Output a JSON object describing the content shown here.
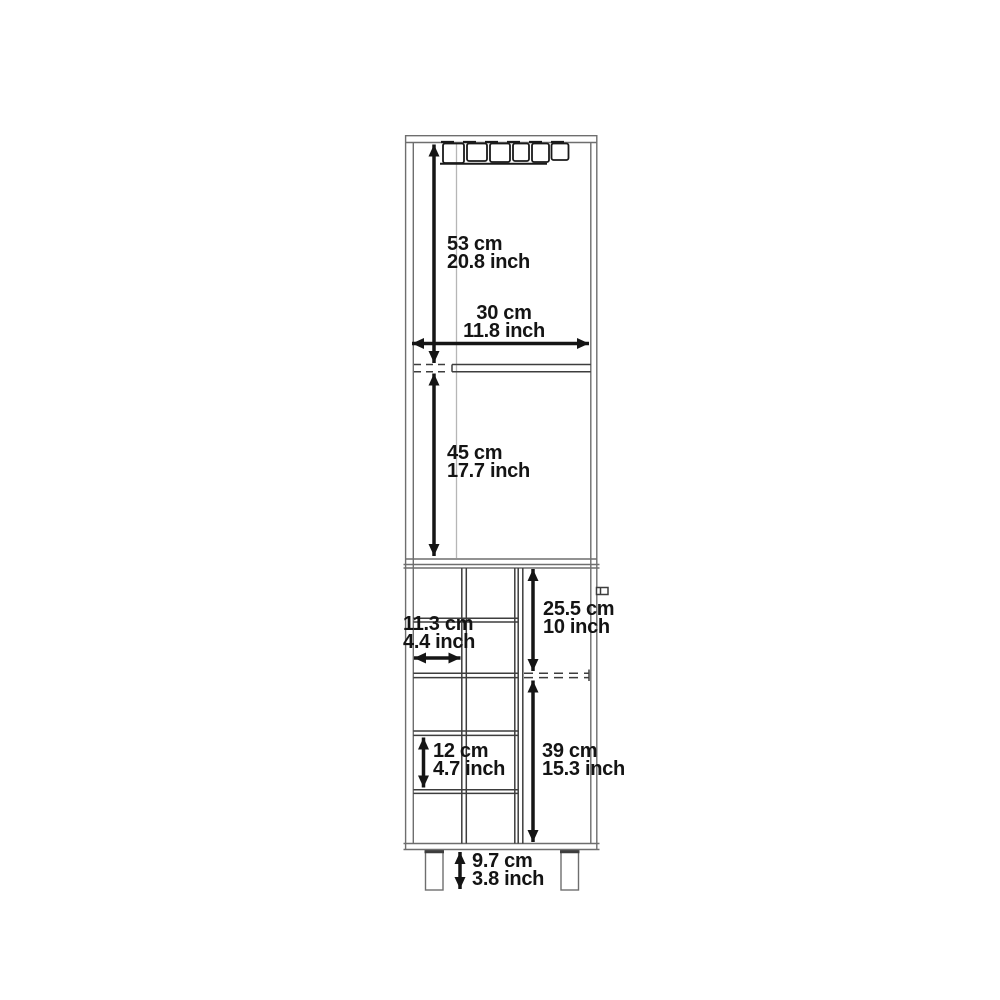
{
  "page": {
    "background": "#ffffff"
  },
  "colors": {
    "outline": "#6e6e6e",
    "detail": "#3d3d3d",
    "faint": "#b6b6b6",
    "ink": "#151515",
    "text": "#141414"
  },
  "dimensions": {
    "upper_section_height": {
      "cm": "53 cm",
      "inch": "20.8 inch"
    },
    "cabinet_width": {
      "cm": "30 cm",
      "inch": "11.8 inch"
    },
    "middle_section_height": {
      "cm": "45 cm",
      "inch": "17.7 inch"
    },
    "cubby_width": {
      "cm": "11.3 cm",
      "inch": "4.4 inch"
    },
    "door_upper_height": {
      "cm": "25.5 cm",
      "inch": "10 inch"
    },
    "cubby_height": {
      "cm": "12 cm",
      "inch": "4.7 inch"
    },
    "door_lower_height": {
      "cm": "39 cm",
      "inch": "15.3 inch"
    },
    "leg_height": {
      "cm": "9.7 cm",
      "inch": "3.8 inch"
    }
  }
}
